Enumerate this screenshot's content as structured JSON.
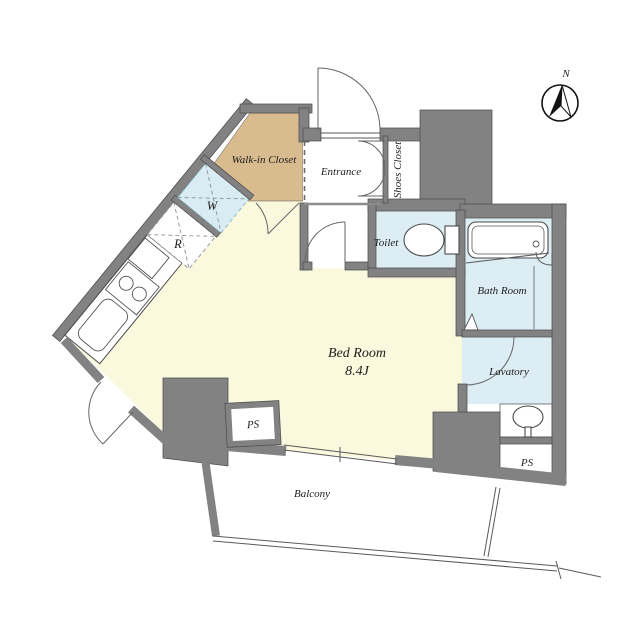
{
  "title": "Apartment floor plan",
  "labels": {
    "walk_in_closet": "Walk-in Closet",
    "entrance": "Entrance",
    "shoes_closet": "Shoes Closet",
    "toilet": "Toilet",
    "bath_room": "Bath Room",
    "lavatory": "Lavatory",
    "bed_room": "Bed Room",
    "bed_room_size": "8.4J",
    "balcony": "Balcony",
    "ps": "PS",
    "washer": "W",
    "refrigerator": "R",
    "north": "N"
  },
  "colors": {
    "wall": "#828282",
    "bedroom_floor": "#faf8dd",
    "closet_floor": "#d8bc90",
    "wet_area_floor": "#dcedf3",
    "washer_box": "#d9ecf3",
    "line": "#4a4a4a"
  }
}
